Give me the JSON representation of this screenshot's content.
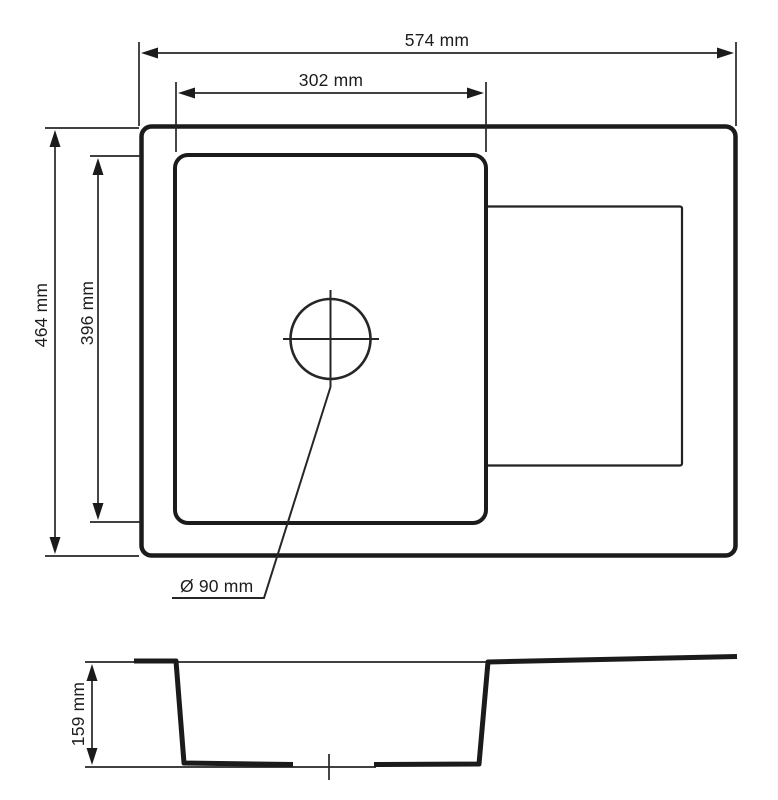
{
  "colors": {
    "background": "#ffffff",
    "line": "#1b1b1b"
  },
  "dimensions": {
    "overall_width": {
      "label": "574 mm"
    },
    "bowl_width": {
      "label": "302 mm"
    },
    "overall_depth": {
      "label": "464 mm"
    },
    "bowl_depth": {
      "label": "396 mm"
    },
    "drain_diameter": {
      "label": "Ø 90 mm"
    },
    "bowl_height": {
      "label": "159 mm"
    }
  }
}
